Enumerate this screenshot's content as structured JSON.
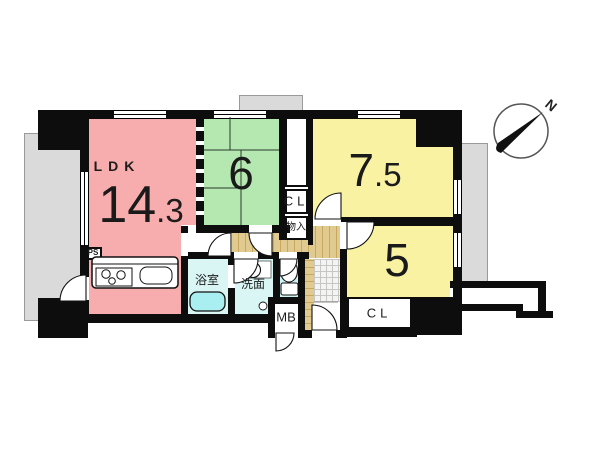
{
  "floor_plan": {
    "rooms": {
      "ldk": {
        "name": "LDK",
        "size_main": "14",
        "size_dec": ".3"
      },
      "japanese_room": {
        "size_main": "6",
        "size_dec": ""
      },
      "bedroom_a": {
        "size_main": "7",
        "size_dec": ".5"
      },
      "bedroom_b": {
        "size_main": "5",
        "size_dec": ""
      },
      "bathroom": {
        "name": "浴室"
      },
      "washroom": {
        "name": "洗面"
      }
    },
    "labels": {
      "closet_hall": "CL",
      "storage_hall": "物入",
      "closet_bedroom": "CL",
      "meter_box": "MB",
      "pipe_space": "PS"
    },
    "compass": {
      "north": "N"
    },
    "colors": {
      "ldk": "#f7adad",
      "japanese_room": "#b5e8b0",
      "bedroom": "#f8f2a2",
      "wet_area": "#d9f6f4",
      "bathtub": "#a9eef0",
      "hallway": "#dfc98f",
      "balcony": "#dadada",
      "wall": "#0d0d0d"
    }
  }
}
